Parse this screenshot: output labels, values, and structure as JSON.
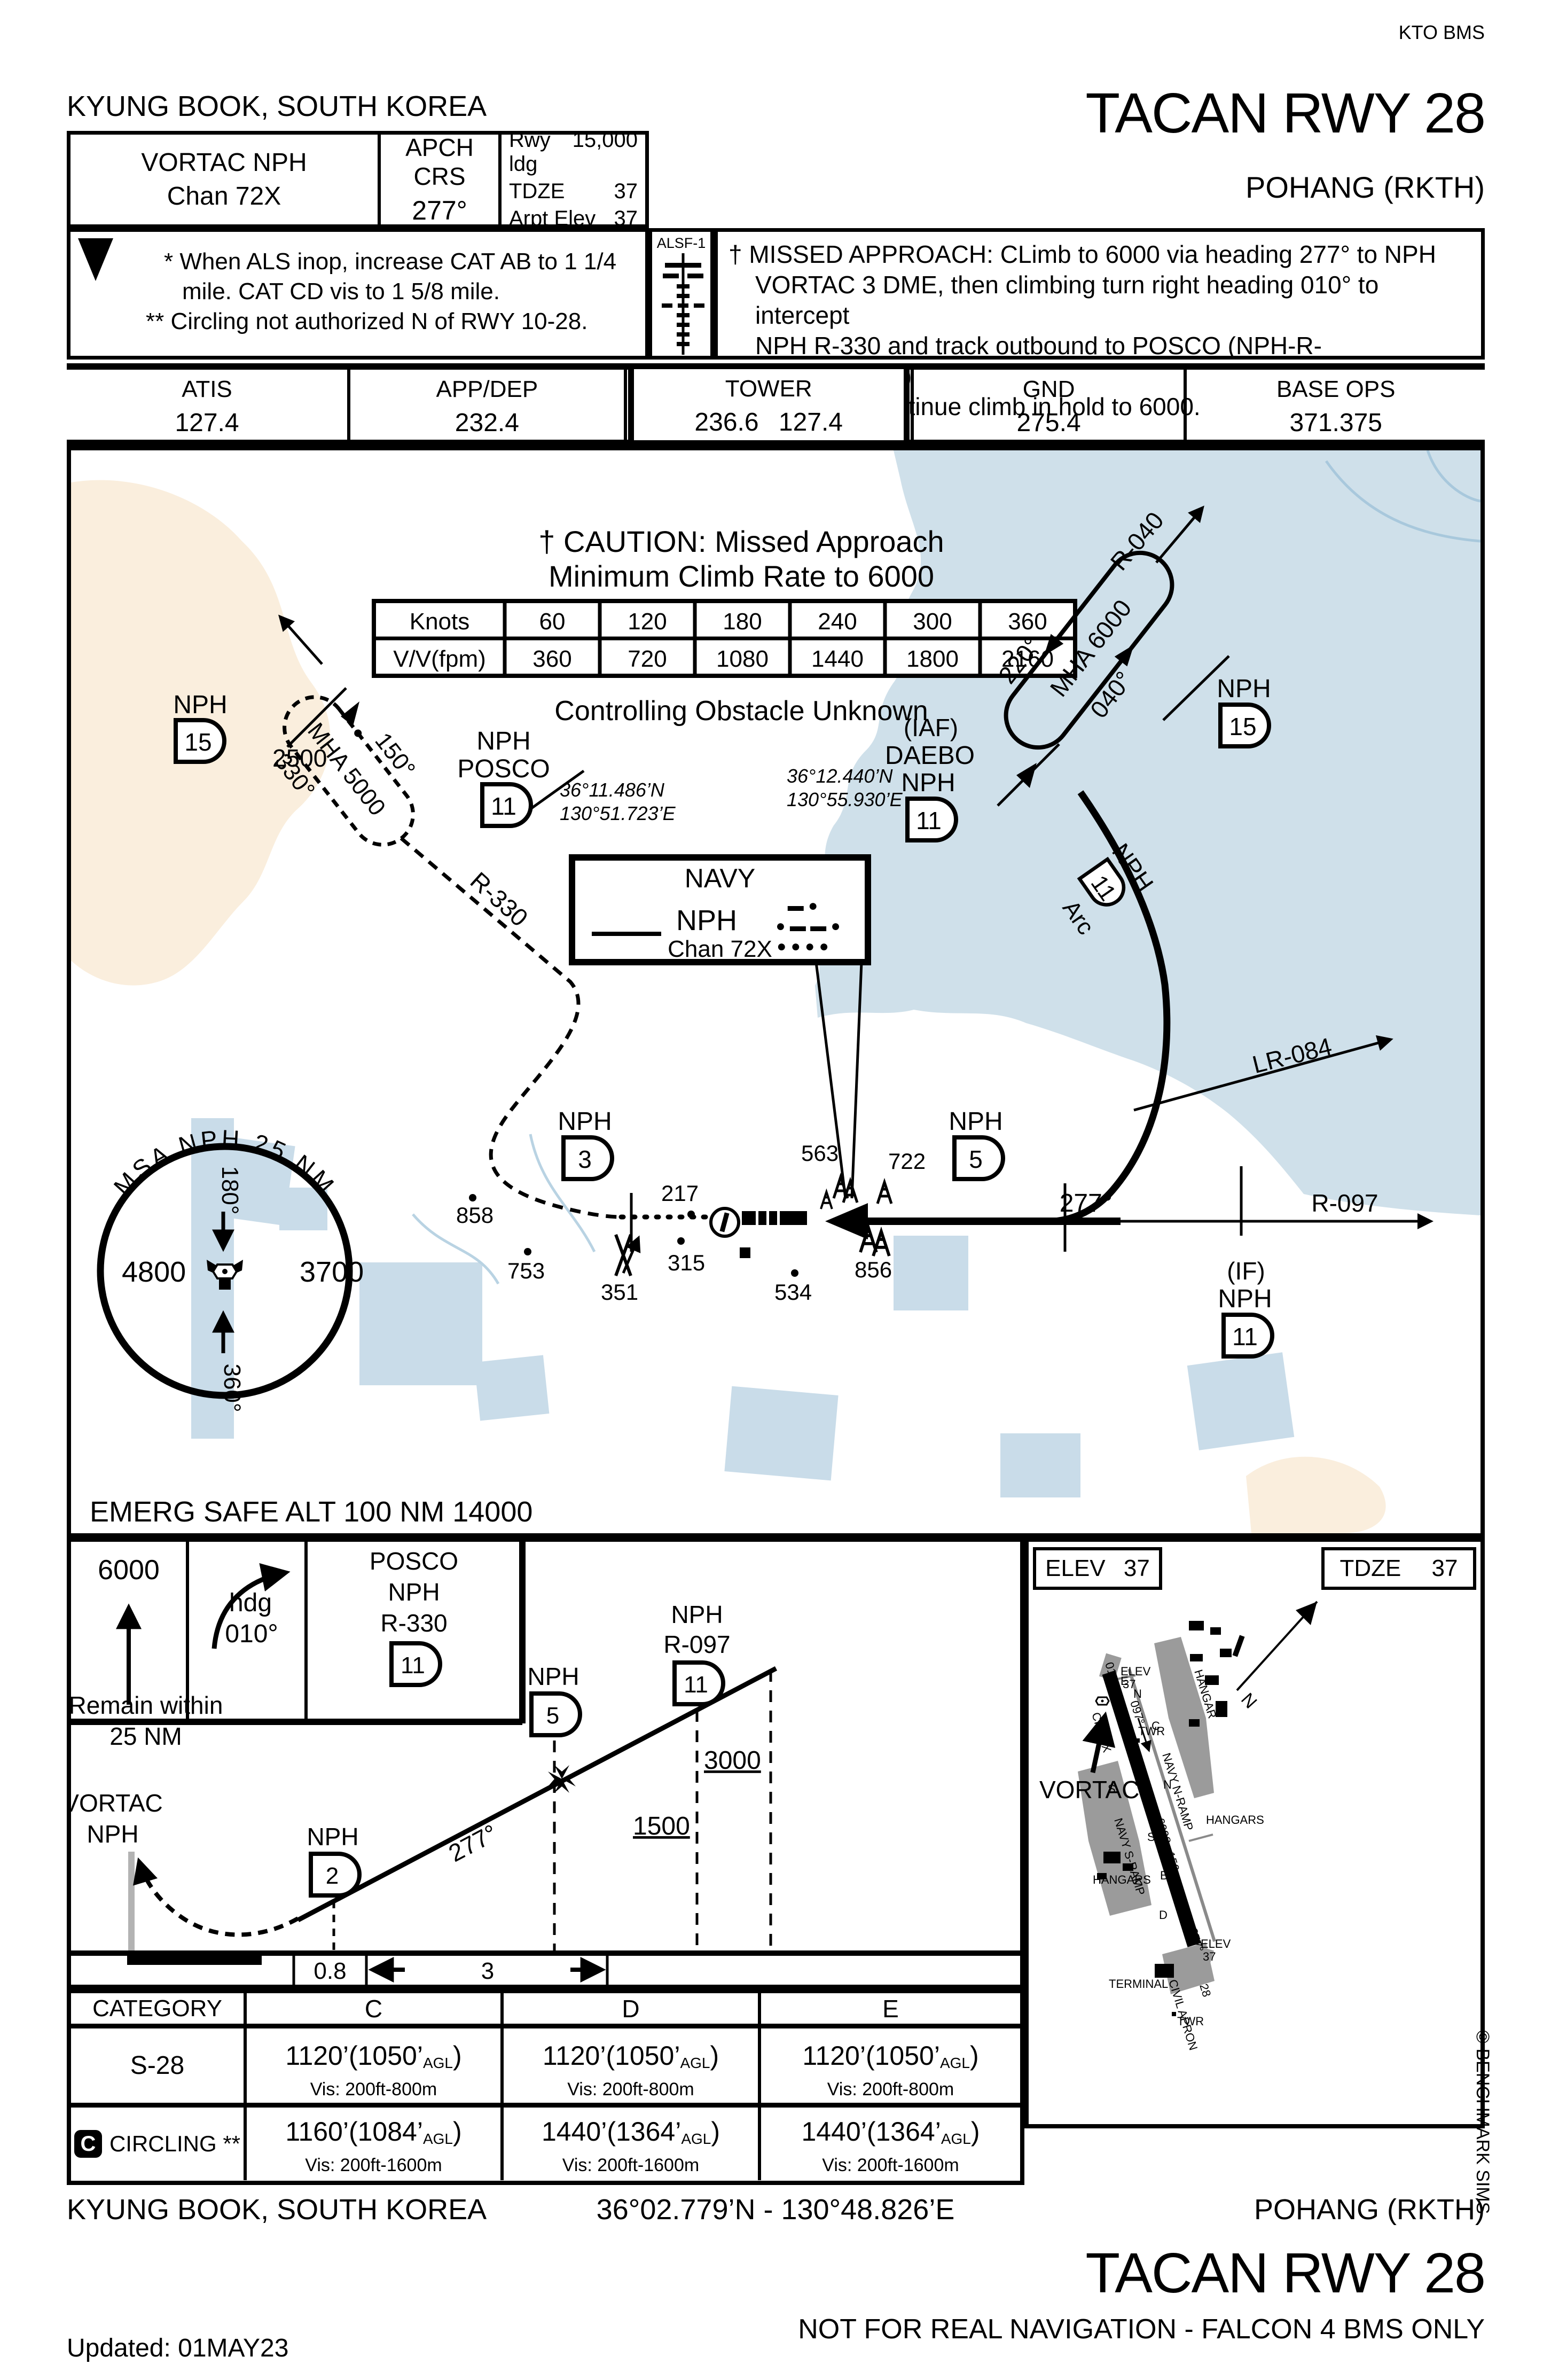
{
  "hdr": {
    "kto": "KTO BMS",
    "city": "KYUNG BOOK, SOUTH KOREA",
    "title": "TACAN RWY 28",
    "airport": "POHANG (RKTH)"
  },
  "box": {
    "navaid1": "VORTAC NPH",
    "navaid2": "Chan 72X",
    "crs1": "APCH CRS",
    "crs2": "277°",
    "r1l": "Rwy ldg",
    "r1v": "15,000",
    "r2l": "TDZE",
    "r2v": "37",
    "r3l": "Arpt Elev",
    "r3v": "37"
  },
  "notes": {
    "t": "T",
    "n1": "* When ALS inop, increase CAT AB to 1 1/4",
    "n2": "mile. CAT CD vis to 1 5/8 mile.",
    "n3": "** Circling not authorized N of RWY 10-28.",
    "alsf": "ALSF-1"
  },
  "missed": {
    "m1": "† MISSED APPROACH: CLimb to 6000 via heading 277° to NPH",
    "m2": "VORTAC 3 DME, then climbing turn right heading 010° to intercept",
    "m3": "NPH R-330 and track outbound to POSCO (NPH-R-330/11.0DME)",
    "m4": "and hold. Continue climb in hold to 6000."
  },
  "freq": {
    "atisl": "ATIS",
    "atis": "127.4",
    "appl": "APP/DEP",
    "app": "232.4",
    "twrl": "TOWER",
    "twr": "236.6  127.4",
    "gndl": "GND",
    "gnd": "275.4",
    "basel": "BASE OPS",
    "base": "371.375"
  },
  "chart_data": {
    "type": "table",
    "title": "Missed Approach Minimum Climb Rate to 6000",
    "categories": [
      "60",
      "120",
      "180",
      "240",
      "300",
      "360"
    ],
    "series": [
      {
        "name": "V/V(fpm)",
        "values": [
          360,
          720,
          1080,
          1440,
          1800,
          2160
        ]
      }
    ],
    "note": "Controlling Obstacle Unknown"
  },
  "plan": {
    "caution1": "† CAUTION: Missed Approach",
    "caution2": "Minimum Climb Rate to 6000",
    "knotsl": "Knots",
    "k": [
      "60",
      "120",
      "180",
      "240",
      "300",
      "360"
    ],
    "vvl": "V/V(fpm)",
    "v": [
      "360",
      "720",
      "1080",
      "1440",
      "1800",
      "2160"
    ],
    "ctrl": "Controlling Obstacle Unknown",
    "posco": {
      "c150": "150°",
      "mha": "MHA 5000",
      "c330": "330°",
      "alt": "2500",
      "nph": "NPH",
      "name": "POSCO",
      "d": "11",
      "lat": "36°11.486’N",
      "lon": "130°51.723’E"
    },
    "daebo": {
      "iaf": "(IAF)",
      "name": "DAEBO",
      "nph": "NPH",
      "d": "11",
      "lat": "36°12.440’N",
      "lon": "130°55.930’E",
      "c220": "220°",
      "mha": "MHA 6000",
      "c040": "040°"
    },
    "nph15": {
      "nph": "NPH",
      "d": "15"
    },
    "nph3": {
      "nph": "NPH",
      "d": "3"
    },
    "nph5": {
      "nph": "NPH",
      "d": "5"
    },
    "iff": {
      "iaf": "(IF)",
      "nph": "NPH",
      "d": "11"
    },
    "arcfix": {
      "nph": "NPH",
      "d": "11",
      "arc": "Arc"
    },
    "navy": {
      "name": "NAVY",
      "nph": "NPH",
      "chan": "Chan 72X",
      "m1": "▬ ●",
      "m2": "● ▬ ▬ ●",
      "m3": "● ● ● ●"
    },
    "r330": "R-330",
    "r040": "R-040",
    "r097": "R-097",
    "lr084": "LR-084",
    "c277": "277°",
    "obs": {
      "a217": "217",
      "a563": "563",
      "a722": "722",
      "a856": "856",
      "a858": "858",
      "a753": "753",
      "a351": "351",
      "a315": "315",
      "a534": "534"
    },
    "msa": {
      "arc": "MSA NPH 25 NM",
      "c180": "180°",
      "c360": "360°",
      "w": "4800",
      "e": "3700"
    },
    "emerg": "EMERG SAFE ALT 100 NM 14000"
  },
  "profile": {
    "a6000": "6000",
    "hdg": "hdg",
    "h010": "010°",
    "posco": "POSCO",
    "nph": "NPH",
    "r330": "R-330",
    "d11": "11",
    "remain1": "Remain within",
    "remain2": "25 NM",
    "vortac": "VORTAC",
    "vnph": "NPH",
    "nph2n": "NPH",
    "nph2d": "2",
    "nph5n": "NPH",
    "nph5d": "5",
    "r097n": "NPH",
    "r097": "R-097",
    "r097d": "11",
    "a3000": "3000",
    "a1500": "1500",
    "c277": "277°",
    "d08": "0.8",
    "d3": "3"
  },
  "mins": {
    "h0": "CATEGORY",
    "h1": "C",
    "h2": "D",
    "h3": "E",
    "s28": "S-28",
    "cbadge": "C",
    "circling": "CIRCLING **",
    "s28c": {
      "m": "1120’(1050’",
      "s": "AGL",
      "p": ")",
      "v": "Vis: 200ft-800m"
    },
    "s28d": {
      "m": "1120’(1050’",
      "s": "AGL",
      "p": ")",
      "v": "Vis: 200ft-800m"
    },
    "s28e": {
      "m": "1120’(1050’",
      "s": "AGL",
      "p": ")",
      "v": "Vis: 200ft-800m"
    },
    "cc": {
      "m": "1160’(1084’",
      "s": "AGL",
      "p": ")",
      "v": "Vis: 200ft-1600m"
    },
    "cd": {
      "m": "1440’(1364’",
      "s": "AGL",
      "p": ")",
      "v": "Vis: 200ft-1600m"
    },
    "ce": {
      "m": "1440’(1364’",
      "s": "AGL",
      "p": ")",
      "v": "Vis: 200ft-1600m"
    }
  },
  "sketch": {
    "elevl": "ELEV",
    "elevv": "37",
    "tdzel": "TDZE",
    "tdzev": "37",
    "vortac": "VORTAC",
    "n": "N",
    "r01": "01",
    "r28": "28",
    "eleva": "ELEV",
    "elevb": "37",
    "h097": "097°",
    "h277": "277°",
    "ch": "CH 72X",
    "twr": "TWR",
    "hangar": "HANGAR",
    "hangars": "HANGARS",
    "nramp": "NAVY N-RAMP",
    "sramp": "NAVY S-RAMP",
    "apron": "CIVIL APRON",
    "terminal": "TERMINAL",
    "dims": "6998 x150"
  },
  "footer": {
    "city": "KYUNG BOOK, SOUTH KOREA",
    "coords": "36°02.779’N - 130°48.826’E",
    "airport": "POHANG (RKTH)",
    "title": "TACAN RWY 28",
    "nfr": "NOT FOR REAL NAVIGATION - FALCON 4 BMS ONLY",
    "updated": "Updated: 01MAY23",
    "copyright": "© BENCHMARK SIMS"
  }
}
